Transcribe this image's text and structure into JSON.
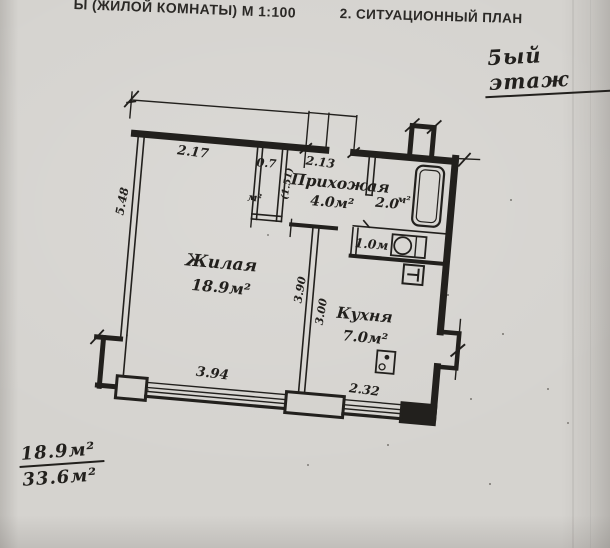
{
  "header": {
    "left": "Ы (ЖИЛОЙ КОМНАТЫ) М 1:100",
    "right": "2. СИТУАЦИОННЫЙ ПЛАН"
  },
  "annotations": {
    "floor_note": "5ый этаж",
    "area_numerator": "18.9м²",
    "area_denominator": "33.6м²"
  },
  "rooms": {
    "living": {
      "name": "Жилая",
      "area": "18.9м²"
    },
    "hallway": {
      "name": "Прихожая",
      "area": "4.0м²"
    },
    "kitchen": {
      "name": "Кухня",
      "area": "7.0м²"
    },
    "closet": {
      "area": "0.7",
      "unit": "м²",
      "width_note": "(1.51)"
    },
    "bathroom": {
      "area": "2.0",
      "unit": "м²"
    },
    "toilet": {
      "area": "1.0м"
    }
  },
  "dimensions": {
    "living_top_width": "2.17",
    "hallway_width": "2.13",
    "left_wall_height": "5.48",
    "living_depth": "3.90",
    "kitchen_depth": "3.00",
    "living_window": "3.94",
    "kitchen_window": "2.32"
  },
  "colors": {
    "paper": "#d5d3cf",
    "ink": "#22201d"
  }
}
